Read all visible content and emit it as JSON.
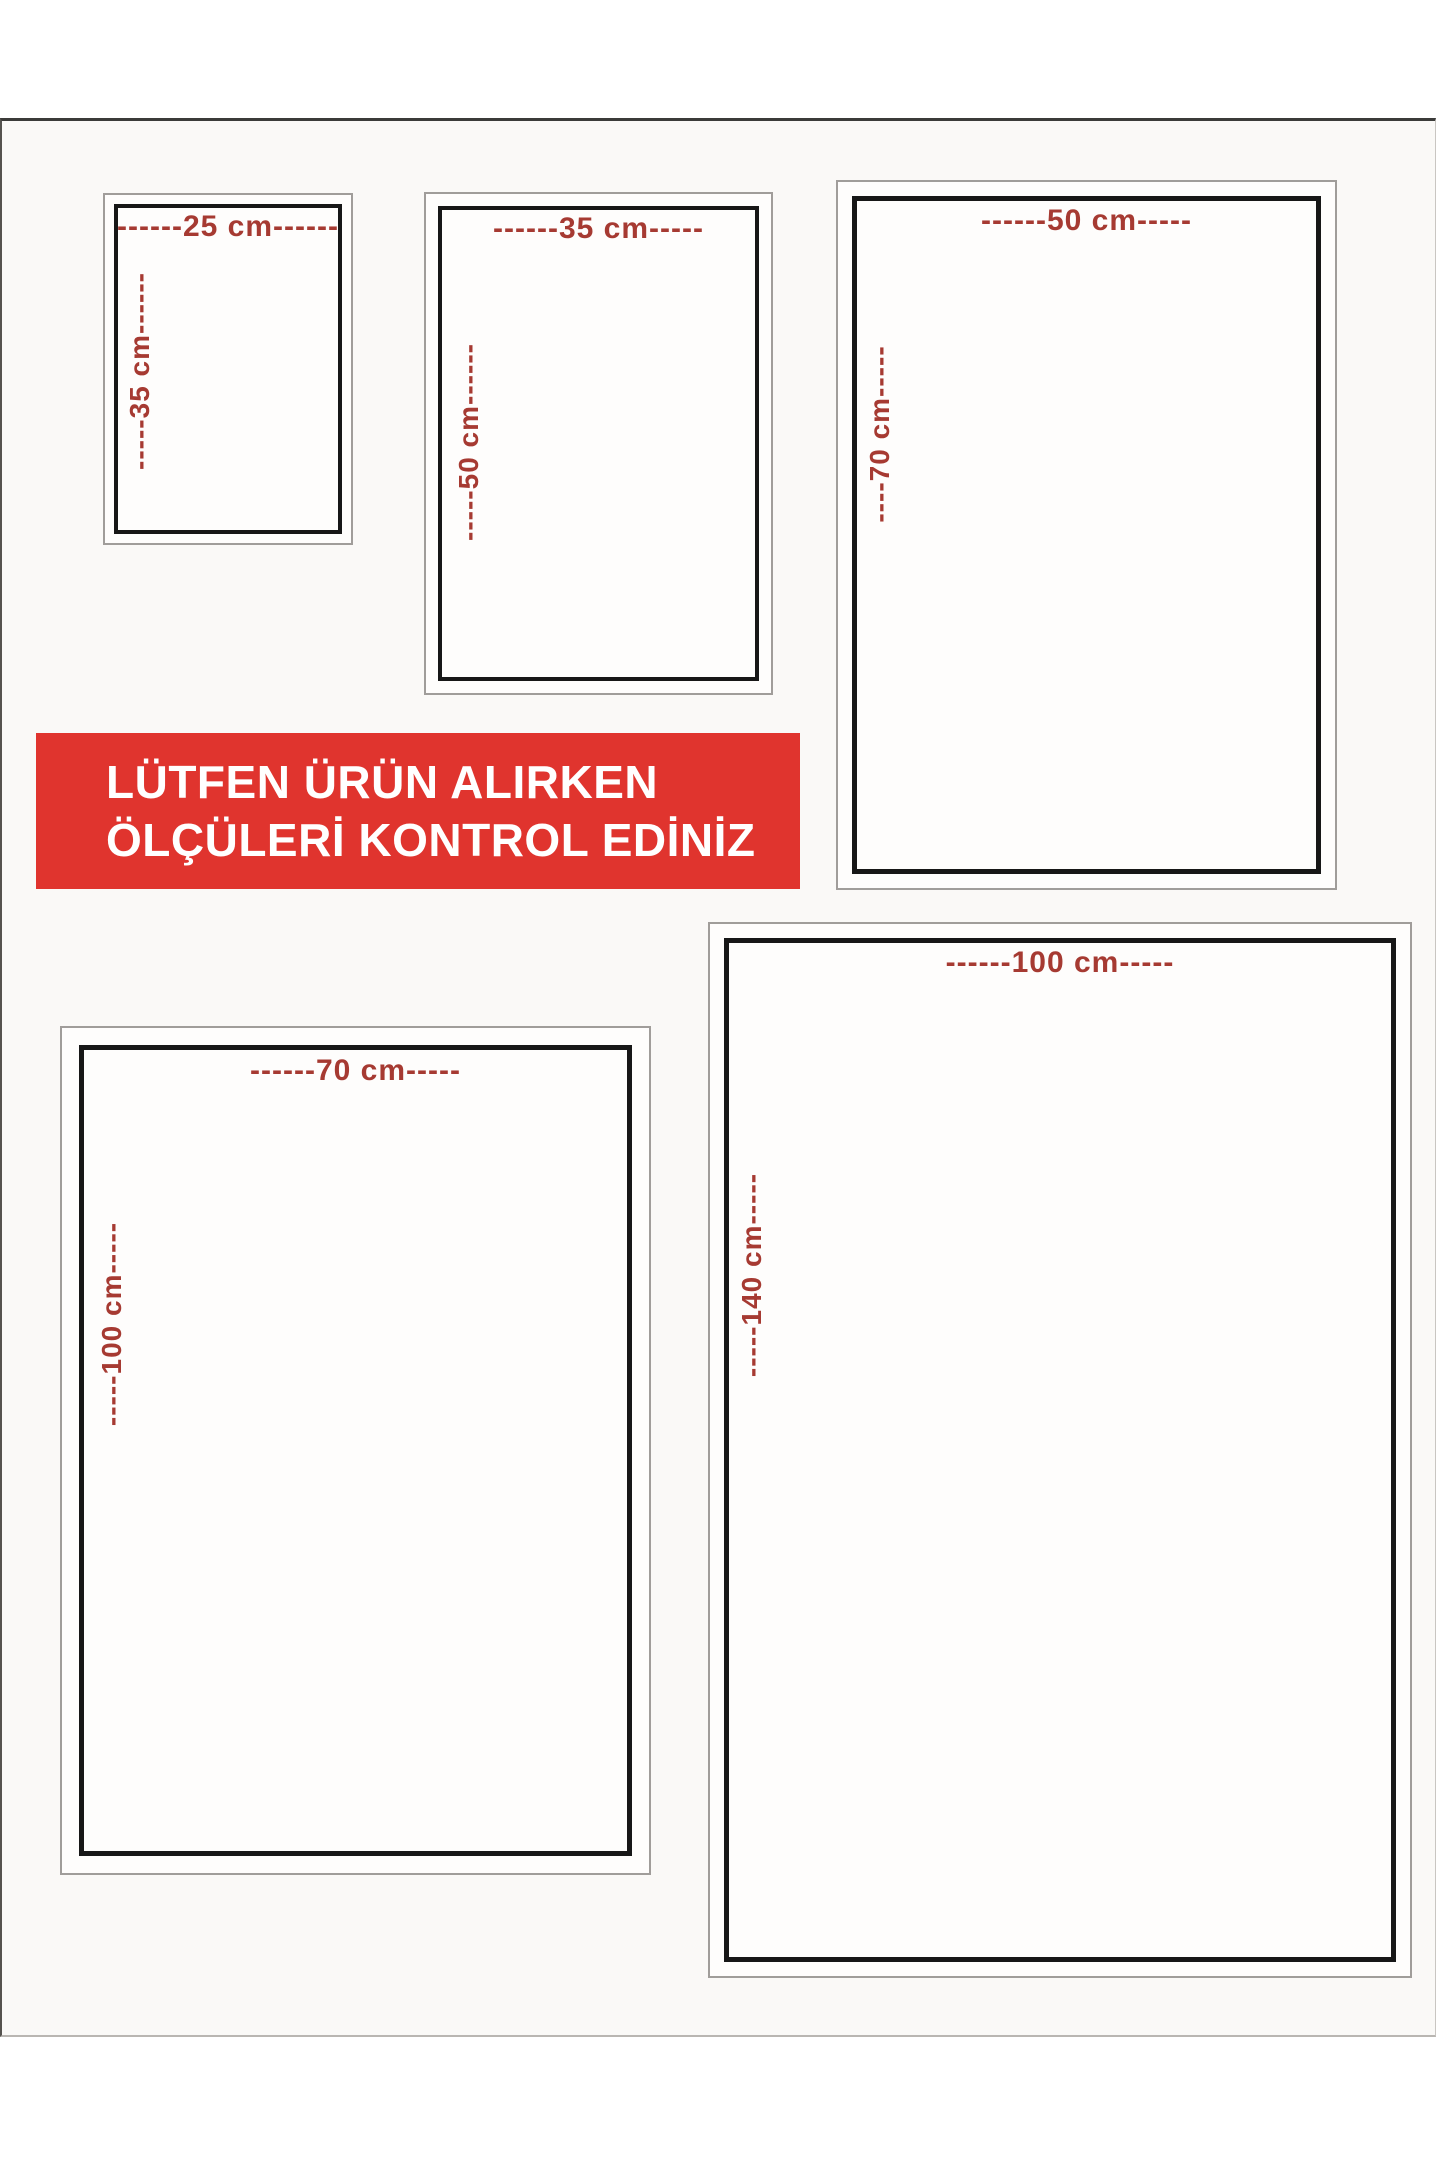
{
  "banner": {
    "line1": "LÜTFEN ÜRÜN ALIRKEN",
    "line2": "ÖLÇÜLERİ KONTROL EDİNİZ",
    "bg_color": "#e0342e",
    "text_color": "#ffffff"
  },
  "colors": {
    "label_red": "#a63a32",
    "banner_red": "#e0342e",
    "border_black": "#171717",
    "border_gray": "#a09d9a",
    "frame_bg": "#faf9f7",
    "page_bg": "#ffffff"
  },
  "sizes": [
    {
      "name": "25x35 cm",
      "width_cm": 25,
      "height_cm": 35,
      "width_label": "------25 cm------",
      "height_label": "-----35 cm------"
    },
    {
      "name": "35x50 cm",
      "width_cm": 35,
      "height_cm": 50,
      "width_label": "------35 cm-----",
      "height_label": "-----50 cm------"
    },
    {
      "name": "50x70 cm",
      "width_cm": 50,
      "height_cm": 70,
      "width_label": "------50 cm-----",
      "height_label": "----70 cm-----"
    },
    {
      "name": "70x100 cm",
      "width_cm": 70,
      "height_cm": 100,
      "width_label": "------70 cm-----",
      "height_label": "-----100 cm-----"
    },
    {
      "name": "100x140 cm",
      "width_cm": 100,
      "height_cm": 140,
      "width_label": "------100 cm-----",
      "height_label": "-----140 cm-----"
    }
  ]
}
